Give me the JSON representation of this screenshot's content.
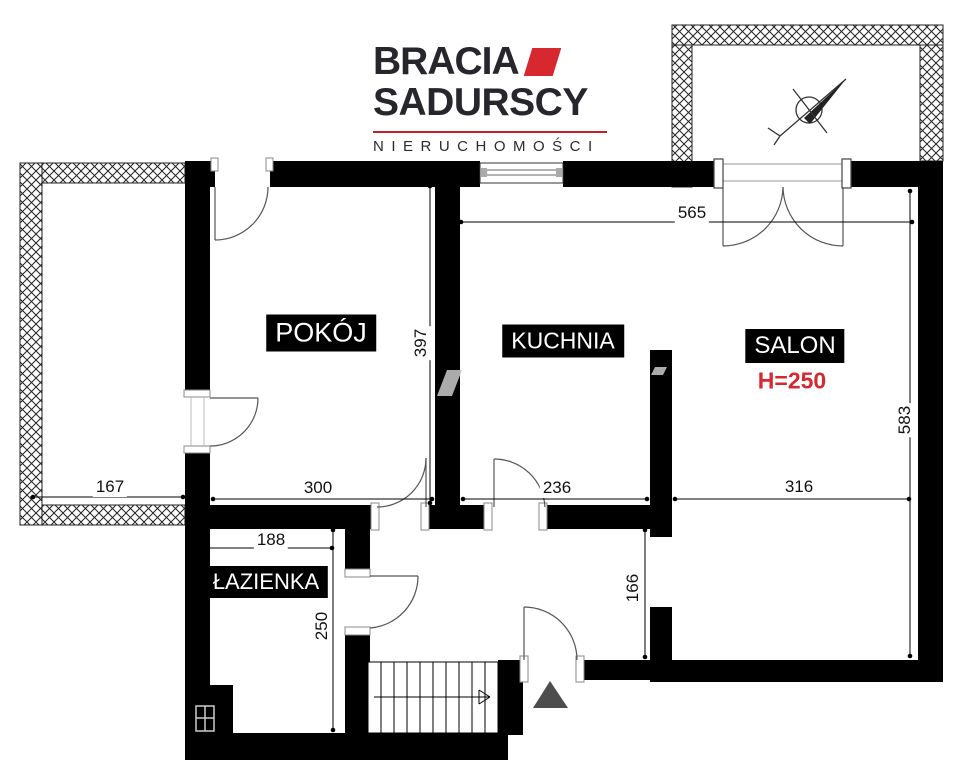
{
  "logo": {
    "brand_line1": "BRACIA",
    "brand_line2": "SADURSCY",
    "tagline": "NIERUCHOMOŚCI"
  },
  "rooms": {
    "pokoj": {
      "label": "POKÓJ"
    },
    "kuchnia": {
      "label": "KUCHNIA"
    },
    "salon": {
      "label": "SALON",
      "height_note": "H=250"
    },
    "lazienka": {
      "label": "ŁAZIENKA"
    }
  },
  "dims": {
    "top_width": "565",
    "pokoj_height": "397",
    "salon_height": "583",
    "left_balcony_width": "167",
    "pokoj_width": "300",
    "kuchnia_width": "236",
    "salon_width": "316",
    "lazienka_width": "188",
    "lazienka_height": "250",
    "hall_opening_height": "166"
  },
  "colors": {
    "wall": "#000000",
    "accent_red": "#d7282f",
    "logo_text": "#26262c",
    "room_label_bg": "#000000",
    "room_label_text": "#ffffff",
    "dim_text": "#111111",
    "entrance_marker": "#4d4d4d",
    "watermark": "#c9c9c9"
  }
}
